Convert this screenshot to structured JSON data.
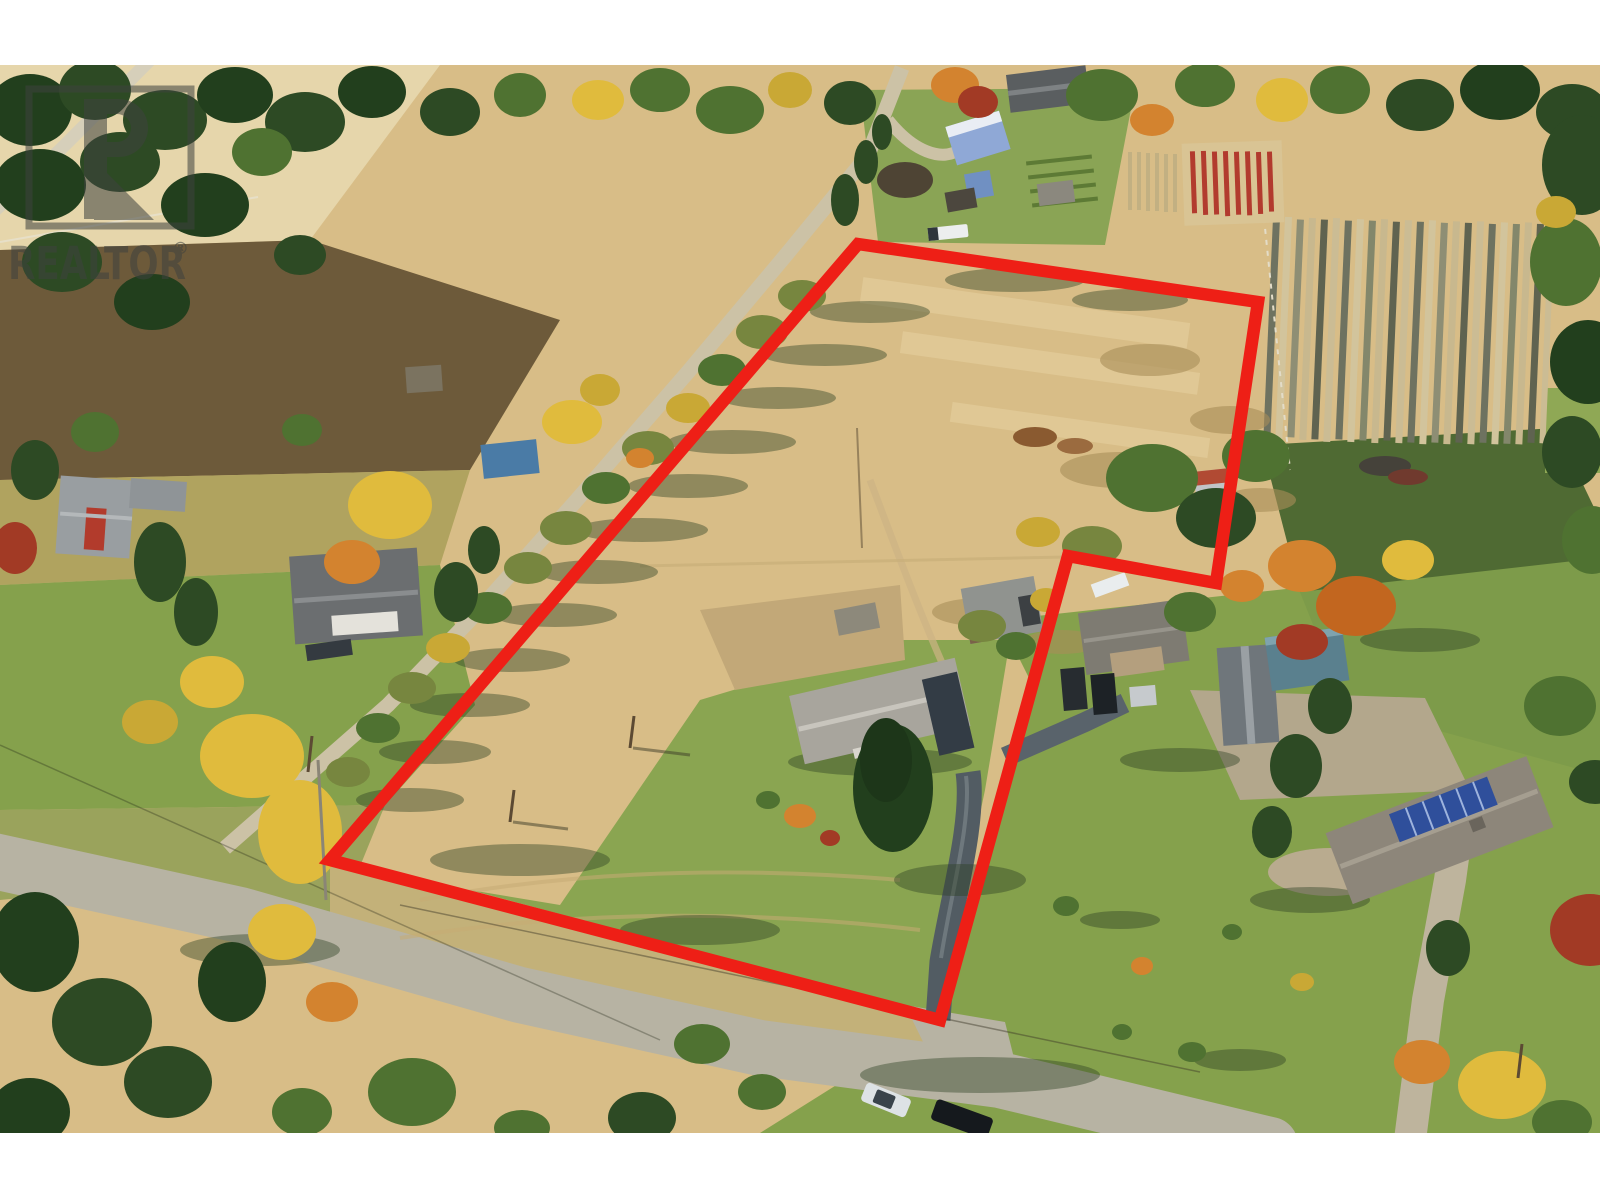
{
  "image": {
    "kind": "aerial drone real-estate photo",
    "season": "autumn",
    "photo_area": {
      "top": 65,
      "bottom": 1133,
      "left": 0,
      "right": 1600
    },
    "letterbox_color": "#ffffff"
  },
  "watermark": {
    "brand": "REALTOR",
    "registered_mark": "®",
    "logo_glyph": "R",
    "color": "#3e423f",
    "opacity": 0.55
  },
  "property_outline": {
    "color": "#ee1f16",
    "stroke_width": 12.5,
    "points": "858,244 1258,302 1216,583 1068,556 940,1020 330,860",
    "description": "red six-vertex boundary polygon with step notch on east side"
  },
  "scene": {
    "features": [
      "tan hay field (subject parcel)",
      "row-crop field with vertical rows (north-east)",
      "red-foliage crop rows",
      "farmstead with sheds, blue canopy and white pickup (north)",
      "rural road crossing lower-left with white car and dark truck",
      "gravel driveways",
      "subject grey-roof rancher with tall spruce in front yard",
      "neighbouring house with parked vehicles",
      "grey barn and teal outbuilding",
      "ranch house with rooftop solar panels (south-east)",
      "autumn deciduous and conifer trees with long eastward shadows"
    ],
    "palette": {
      "hay": "#d8bd87",
      "hay_light": "#e6d3a4",
      "lawn": "#85a14c",
      "lawn_dark": "#5d7d3a",
      "conifer": "#2d4a24",
      "deciduous": "#4f7231",
      "autumn_yellow": "#e0bb3d",
      "autumn_orange": "#d3832f",
      "autumn_red": "#a23a25",
      "road": "#b7b3a3",
      "gravel": "#c9bfa4",
      "asphalt_shade": "#525c63",
      "roof_grey": "#a8a59d",
      "solar_blue": "#2f4f9b",
      "crop_row_dark": "#6e7260",
      "red_crop_row": "#b23a2e"
    }
  }
}
